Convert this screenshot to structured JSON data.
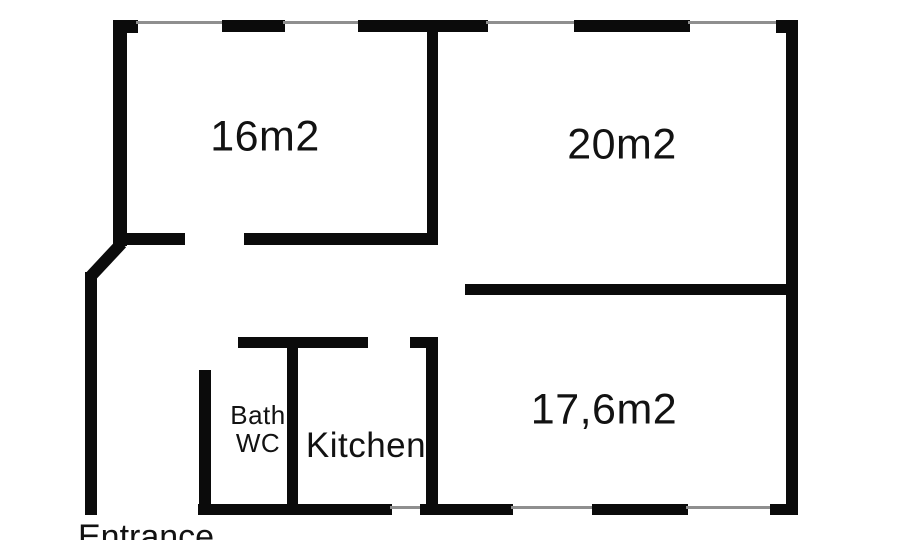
{
  "title": "Apartment floor plan",
  "labels": {
    "room16": "16m2",
    "room20": "20m2",
    "room176": "17,6m2",
    "bath_line1": "Bath",
    "bath_line2": "WC",
    "kitchen": "Kitchen",
    "entrance": "Entrance"
  },
  "colors": {
    "wall": "#0b0b0b",
    "window_line": "#8f8f8f",
    "background": "#ffffff",
    "text": "#121212"
  }
}
